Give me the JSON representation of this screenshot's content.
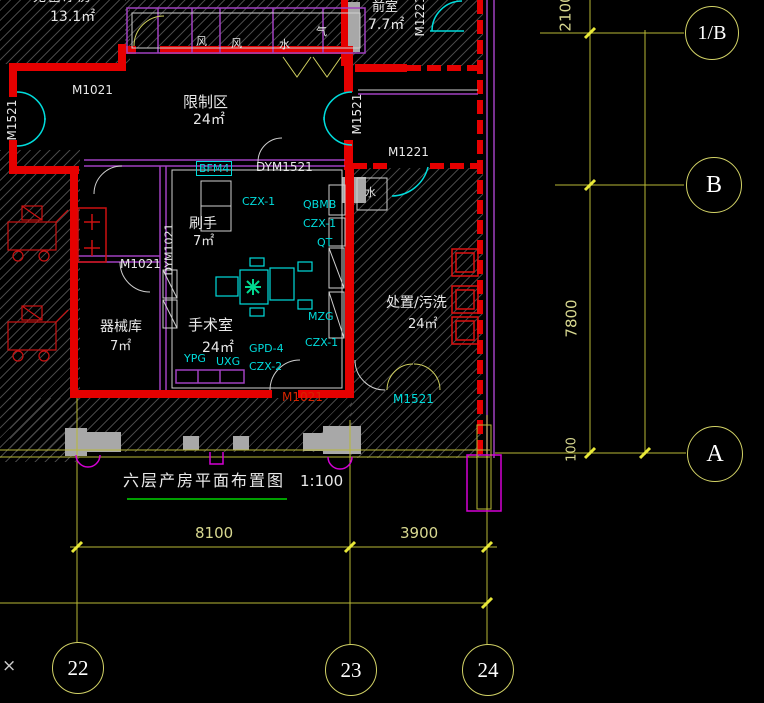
{
  "drawing": {
    "title": "六层产房平面布置图",
    "scale": "1:100",
    "rooms": [
      {
        "name": "无菌净房",
        "area": "13.1㎡"
      },
      {
        "name": "前室",
        "area": "7.7㎡"
      },
      {
        "name": "限制区",
        "area": "24㎡"
      },
      {
        "name": "刷手",
        "area": "7㎡"
      },
      {
        "name": "器械库",
        "area": "7㎡"
      },
      {
        "name": "手术室",
        "area": "24㎡"
      },
      {
        "name": "处置/污洗",
        "area": "24㎡"
      }
    ],
    "doors": {
      "m1021_top": "M1021",
      "m1521_left": "M1521",
      "m1521_right": "M1521",
      "m1221_top": "M1221",
      "m1221_mid": "M1221",
      "dym1521": "DYM1521",
      "dym1021": "DYM1021",
      "m1021_scrub": "M1021",
      "m1021_or": "M1021",
      "m1521_bottom": "M1521"
    },
    "equipment": {
      "bfm4": "BFM4",
      "czx1_a": "CZX-1",
      "qbmb": "QBMB",
      "czx1_b": "CZX-1",
      "qt": "QT",
      "mzg": "MZG",
      "czx1_c": "CZX-1",
      "gpd4": "GPD-4",
      "czx2": "CZX-2",
      "ypg": "YPG",
      "uxg": "UXG"
    },
    "shafts": {
      "s1": "风",
      "s2": "风",
      "s3": "水",
      "s4": "气",
      "s5": "水"
    },
    "grid": {
      "right": [
        "1/B",
        "B",
        "A"
      ],
      "bottom": [
        "22",
        "23",
        "24"
      ]
    },
    "dimensions": {
      "v2100": "2100",
      "v7800": "7800",
      "v100": "100",
      "h8100": "8100",
      "h3900": "3900"
    },
    "misc": {
      "x_mark": "×"
    },
    "colors": {
      "wall_red": "#e60000",
      "line_cyan": "#00dcdc",
      "line_purple": "#a040c0",
      "grid_yellow": "#c8c84a",
      "underline_green": "#00a000",
      "column_gray": "#a8a8a8",
      "pier_magenta": "#d400d4"
    }
  }
}
